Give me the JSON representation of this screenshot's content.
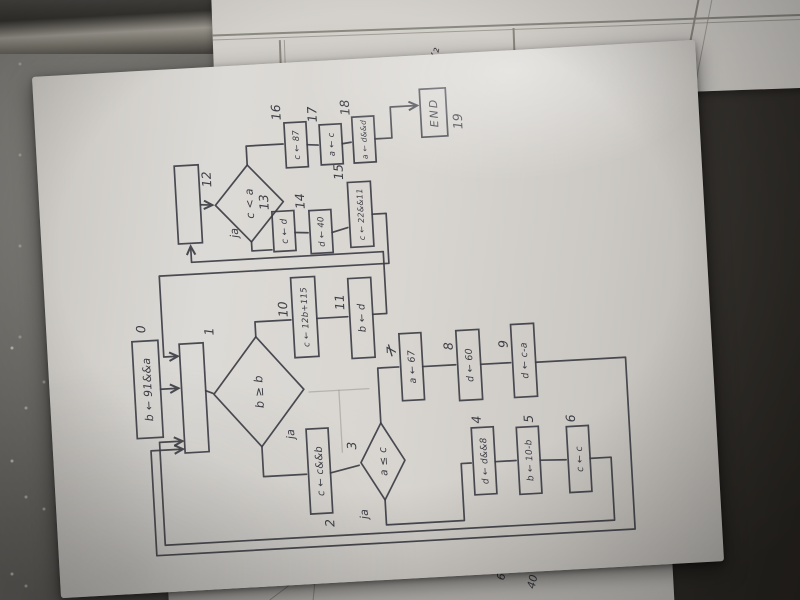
{
  "photo": {
    "under_sheet_top_label": "-x₂",
    "under_sheet_bottom_labels": [
      "61 —",
      "40 —"
    ]
  },
  "flowchart": {
    "ink_color": "#3d3d45",
    "paper_color": "#d8d5d0",
    "yes_label": "ja",
    "nodes": [
      {
        "id": "start",
        "type": "process",
        "text": "b ← 91&&a",
        "x": 157,
        "y": 86,
        "w": 97,
        "h": 26,
        "fs": 11,
        "num": "0",
        "num_x": 262,
        "num_y": 100
      },
      {
        "id": "merge1",
        "type": "process",
        "text": "",
        "x": 140,
        "y": 133,
        "w": 109,
        "h": 24,
        "num": "1",
        "num_x": 256,
        "num_y": 168
      },
      {
        "id": "d1",
        "type": "decision",
        "text": "b ≥ b",
        "x": 142,
        "y": 165,
        "w": 110,
        "h": 90,
        "fs": 11.5
      },
      {
        "id": "n2",
        "type": "process",
        "text": "c ← c&&b",
        "x": 72,
        "y": 255,
        "w": 85,
        "h": 22,
        "fs": 10,
        "num": "2",
        "num_x": 58,
        "num_y": 278
      },
      {
        "id": "d3",
        "type": "decision",
        "text": "a ≤ c",
        "x": 82,
        "y": 308,
        "w": 77,
        "h": 44,
        "fs": 10.5,
        "num": "3",
        "num_x": 134,
        "num_y": 304
      },
      {
        "id": "n4",
        "type": "process",
        "text": "d ← d&&8",
        "x": 82,
        "y": 420,
        "w": 67,
        "h": 22,
        "fs": 9,
        "num": "4",
        "num_x": 153,
        "num_y": 430
      },
      {
        "id": "n5",
        "type": "process",
        "text": "b ← 10-b",
        "x": 80,
        "y": 465,
        "w": 67,
        "h": 22,
        "fs": 9,
        "num": "5",
        "num_x": 151,
        "num_y": 482
      },
      {
        "id": "n6",
        "type": "process",
        "text": "c ← c",
        "x": 79,
        "y": 515,
        "w": 66,
        "h": 22,
        "fs": 9.5,
        "num": "6",
        "num_x": 149,
        "num_y": 524
      },
      {
        "id": "n7",
        "type": "process",
        "text": "a ← 67",
        "x": 180,
        "y": 353,
        "w": 67,
        "h": 22,
        "fs": 9.5,
        "num": "7",
        "num_x": 227,
        "num_y": 349,
        "num_strike": true
      },
      {
        "id": "n8",
        "type": "process",
        "text": "d ← 60",
        "x": 177,
        "y": 410,
        "w": 70,
        "h": 23,
        "fs": 9.5,
        "num": "8",
        "num_x": 228,
        "num_y": 406
      },
      {
        "id": "n9",
        "type": "process",
        "text": "d ← c-a",
        "x": 177,
        "y": 465,
        "w": 73,
        "h": 23,
        "fs": 9.5,
        "num": "9",
        "num_x": 227,
        "num_y": 461
      },
      {
        "id": "n10",
        "type": "process",
        "text": "c ← 12b+115",
        "x": 229,
        "y": 248,
        "w": 80,
        "h": 24,
        "fs": 8.5,
        "num": "10",
        "num_x": 270,
        "num_y": 243
      },
      {
        "id": "n11",
        "type": "process",
        "text": "b ← d",
        "x": 225,
        "y": 305,
        "w": 80,
        "h": 23,
        "fs": 10,
        "num": "11",
        "num_x": 274,
        "num_y": 300
      },
      {
        "id": "merge12",
        "type": "process",
        "text": "",
        "x": 349,
        "y": 138,
        "w": 78,
        "h": 24,
        "num": "12",
        "num_x": 404,
        "num_y": 174
      },
      {
        "id": "d12",
        "type": "decision",
        "text": "c < a",
        "x": 347,
        "y": 177,
        "w": 77,
        "h": 68,
        "fs": 11
      },
      {
        "id": "n13",
        "type": "process",
        "text": "c ← d",
        "x": 336,
        "y": 233,
        "w": 40,
        "h": 22,
        "fs": 9,
        "num": "13",
        "num_x": 378,
        "num_y": 230
      },
      {
        "id": "n14",
        "type": "process",
        "text": "d ← 40",
        "x": 332,
        "y": 270,
        "w": 43,
        "h": 22,
        "fs": 8.5,
        "num": "14",
        "num_x": 377,
        "num_y": 266
      },
      {
        "id": "n15",
        "type": "process",
        "text": "c ← 22&&11",
        "x": 336,
        "y": 310,
        "w": 65,
        "h": 23,
        "fs": 8,
        "num": "15",
        "num_x": 404,
        "num_y": 306
      },
      {
        "id": "n16",
        "type": "process",
        "text": "c ← 87",
        "x": 419,
        "y": 250,
        "w": 45,
        "h": 22,
        "fs": 8.5,
        "num": "16",
        "num_x": 467,
        "num_y": 247
      },
      {
        "id": "n17",
        "type": "process",
        "text": "a ← c",
        "x": 420,
        "y": 285,
        "w": 40,
        "h": 22,
        "fs": 8.5,
        "num": "17",
        "num_x": 463,
        "num_y": 283
      },
      {
        "id": "n18",
        "type": "process",
        "text": "a ← d&&d",
        "x": 420,
        "y": 318,
        "w": 46,
        "h": 22,
        "fs": 7.5,
        "num": "18",
        "num_x": 468,
        "num_y": 316
      },
      {
        "id": "end",
        "type": "terminal",
        "text": "END",
        "x": 442,
        "y": 387,
        "w": 48,
        "h": 26,
        "fs": 11,
        "num": "19",
        "num_x": 448,
        "num_y": 428
      }
    ],
    "ja_labels": [
      {
        "text": "ja",
        "x": 148,
        "y": 243
      },
      {
        "text": "ja",
        "x": 64,
        "y": 312
      },
      {
        "text": "ja",
        "x": 352,
        "y": 198
      }
    ],
    "edges": [
      {
        "points": [
          [
            205,
            112
          ],
          [
            205,
            130
          ]
        ],
        "arrow": true
      },
      {
        "points": [
          [
            201,
            157
          ],
          [
            198,
            164
          ]
        ]
      },
      {
        "points": [
          [
            142,
            210
          ],
          [
            112,
            210
          ],
          [
            112,
            253
          ]
        ]
      },
      {
        "points": [
          [
            112,
            277
          ],
          [
            118,
            306
          ]
        ]
      },
      {
        "points": [
          [
            82,
            330
          ],
          [
            57,
            330
          ],
          [
            57,
            408
          ],
          [
            114,
            408
          ],
          [
            114,
            418
          ]
        ]
      },
      {
        "points": [
          [
            114,
            442
          ],
          [
            114,
            463
          ]
        ]
      },
      {
        "points": [
          [
            113,
            487
          ],
          [
            112,
            513
          ]
        ]
      },
      {
        "points": [
          [
            112,
            537
          ],
          [
            112,
            558
          ],
          [
            49,
            558
          ],
          [
            49,
            108
          ],
          [
            152,
            108
          ],
          [
            152,
            131
          ]
        ],
        "arrow": true
      },
      {
        "points": [
          [
            159,
            330
          ],
          [
            214,
            330
          ],
          [
            214,
            351
          ]
        ]
      },
      {
        "points": [
          [
            213,
            375
          ],
          [
            213,
            408
          ]
        ]
      },
      {
        "points": [
          [
            212,
            433
          ],
          [
            212,
            463
          ]
        ]
      },
      {
        "points": [
          [
            211,
            488
          ],
          [
            211,
            578
          ],
          [
            39,
            578
          ],
          [
            39,
            99
          ],
          [
            144,
            99
          ],
          [
            144,
            131
          ]
        ],
        "arrow": true
      },
      {
        "points": [
          [
            252,
            210
          ],
          [
            267,
            210
          ],
          [
            267,
            246
          ]
        ]
      },
      {
        "points": [
          [
            267,
            272
          ],
          [
            267,
            303
          ]
        ]
      },
      {
        "points": [
          [
            268,
            328
          ],
          [
            268,
            342
          ],
          [
            330,
            342
          ],
          [
            330,
            150
          ],
          [
            346,
            150
          ]
        ],
        "arrow": true
      },
      {
        "points": [
          [
            368,
            333
          ],
          [
            368,
            347
          ],
          [
            318,
            347
          ],
          [
            318,
            117
          ],
          [
            237,
            117
          ],
          [
            237,
            131
          ]
        ],
        "arrow": true
      },
      {
        "points": [
          [
            387,
            162
          ],
          [
            386,
            174
          ]
        ],
        "arrow": true
      },
      {
        "points": [
          [
            347,
            211
          ],
          [
            338,
            211
          ],
          [
            338,
            231
          ]
        ]
      },
      {
        "points": [
          [
            354,
            255
          ],
          [
            353,
            268
          ]
        ]
      },
      {
        "points": [
          [
            352,
            292
          ],
          [
            356,
            308
          ]
        ]
      },
      {
        "points": [
          [
            424,
            211
          ],
          [
            443,
            211
          ],
          [
            443,
            248
          ]
        ]
      },
      {
        "points": [
          [
            441,
            272
          ],
          [
            440,
            283
          ]
        ]
      },
      {
        "points": [
          [
            440,
            307
          ],
          [
            441,
            316
          ]
        ]
      },
      {
        "points": [
          [
            443,
            340
          ],
          [
            443,
            357
          ],
          [
            474,
            357
          ],
          [
            474,
            384
          ]
        ],
        "arrow": true
      }
    ],
    "stray_marks": [
      {
        "points": [
          [
            132,
            290
          ],
          [
            194,
            290
          ]
        ]
      },
      {
        "points": [
          [
            194,
            260
          ],
          [
            194,
            320
          ]
        ]
      }
    ]
  }
}
